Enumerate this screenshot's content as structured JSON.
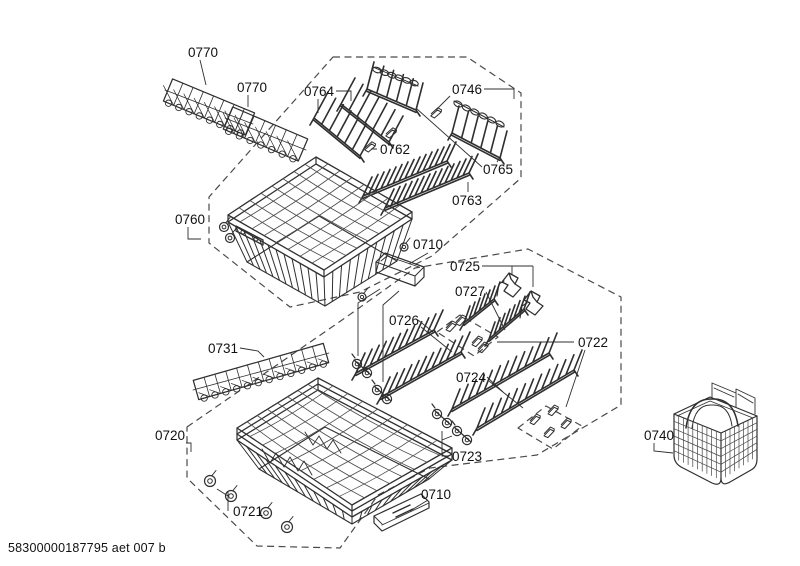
{
  "footer": {
    "code": "58300000187795 aet 007 b"
  },
  "diagram": {
    "type": "exploded-parts-diagram",
    "colors": {
      "line": "#2f2f2f",
      "dash": "#4a4a4a",
      "background": "#ffffff",
      "label": "#111111"
    },
    "part_labels": [
      {
        "id": "0770-left",
        "number": "0770"
      },
      {
        "id": "0770-right",
        "number": "0770"
      },
      {
        "id": "0764",
        "number": "0764"
      },
      {
        "id": "0746",
        "number": "0746"
      },
      {
        "id": "0762",
        "number": "0762"
      },
      {
        "id": "0765",
        "number": "0765"
      },
      {
        "id": "0763",
        "number": "0763"
      },
      {
        "id": "0760",
        "number": "0760"
      },
      {
        "id": "0710-upper",
        "number": "0710"
      },
      {
        "id": "0725",
        "number": "0725"
      },
      {
        "id": "0727",
        "number": "0727"
      },
      {
        "id": "0726",
        "number": "0726"
      },
      {
        "id": "0722",
        "number": "0722"
      },
      {
        "id": "0724",
        "number": "0724"
      },
      {
        "id": "0731",
        "number": "0731"
      },
      {
        "id": "0720",
        "number": "0720"
      },
      {
        "id": "0723",
        "number": "0723"
      },
      {
        "id": "0721",
        "number": "0721"
      },
      {
        "id": "0710-lower",
        "number": "0710"
      },
      {
        "id": "0740",
        "number": "0740"
      }
    ]
  }
}
